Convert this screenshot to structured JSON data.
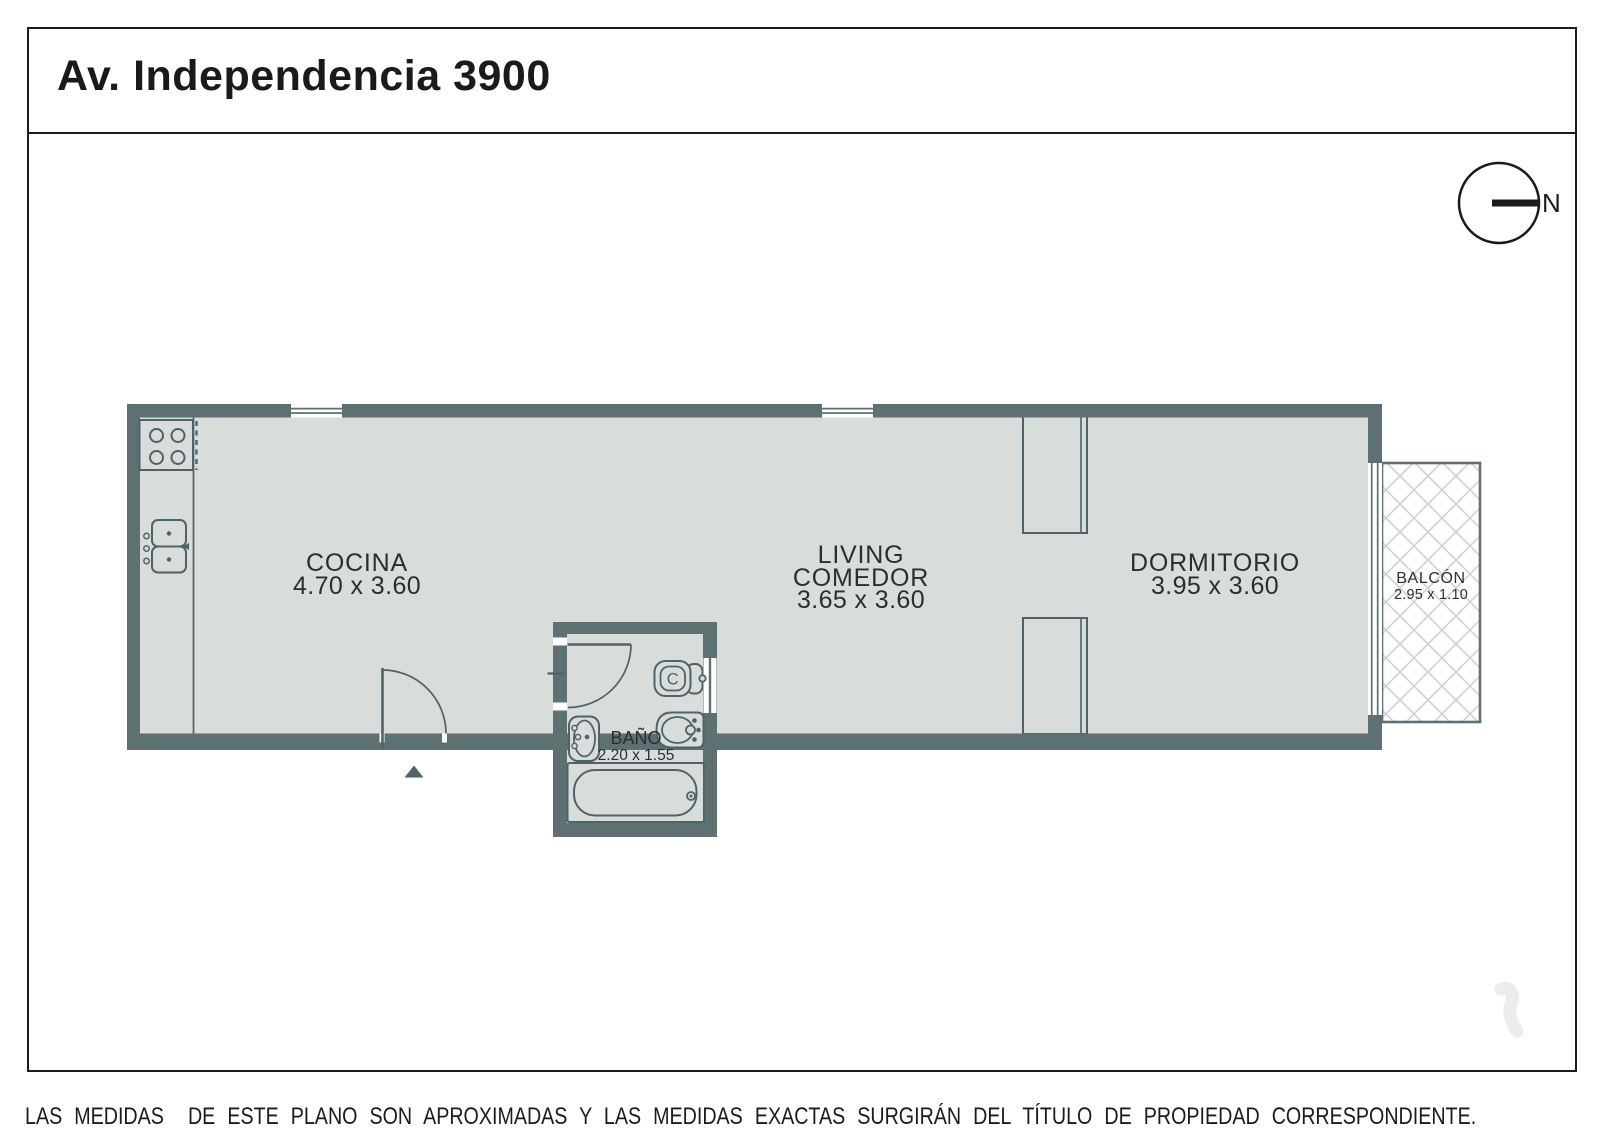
{
  "header": {
    "title": "Av. Independencia 3900"
  },
  "compass": {
    "label": "N"
  },
  "rooms": {
    "kitchen": {
      "name": "COCINA",
      "dims": "4.70 x 3.60"
    },
    "living": {
      "name_line1": "LIVING",
      "name_line2": "COMEDOR",
      "dims": "3.65 x 3.60"
    },
    "bedroom": {
      "name": "DORMITORIO",
      "dims": "3.95 x 3.60"
    },
    "bathroom": {
      "name": "BAÑO",
      "dims": "2.20 x 1.55"
    },
    "balcony": {
      "name": "BALCÓN",
      "dims": "2.95 x 1.10"
    }
  },
  "fixtures": {
    "toilet_glyph": "C"
  },
  "footer": {
    "disclaimer": "LAS MEDIDAS  DE ESTE PLANO SON APROXIMADAS Y LAS MEDIDAS EXACTAS SURGIRÁN DEL TÍTULO DE PROPIEDAD CORRESPONDIENTE.",
    "credit": "CONFECCIONADO POR ESTUDIO NARTEX"
  },
  "colors": {
    "wall": "#5d7173",
    "floor": "#d8dcda",
    "fixture_line": "#4e6367",
    "ink": "#1b1b1b",
    "hatch": "#cdd3d4",
    "watermark": "#ececec"
  }
}
